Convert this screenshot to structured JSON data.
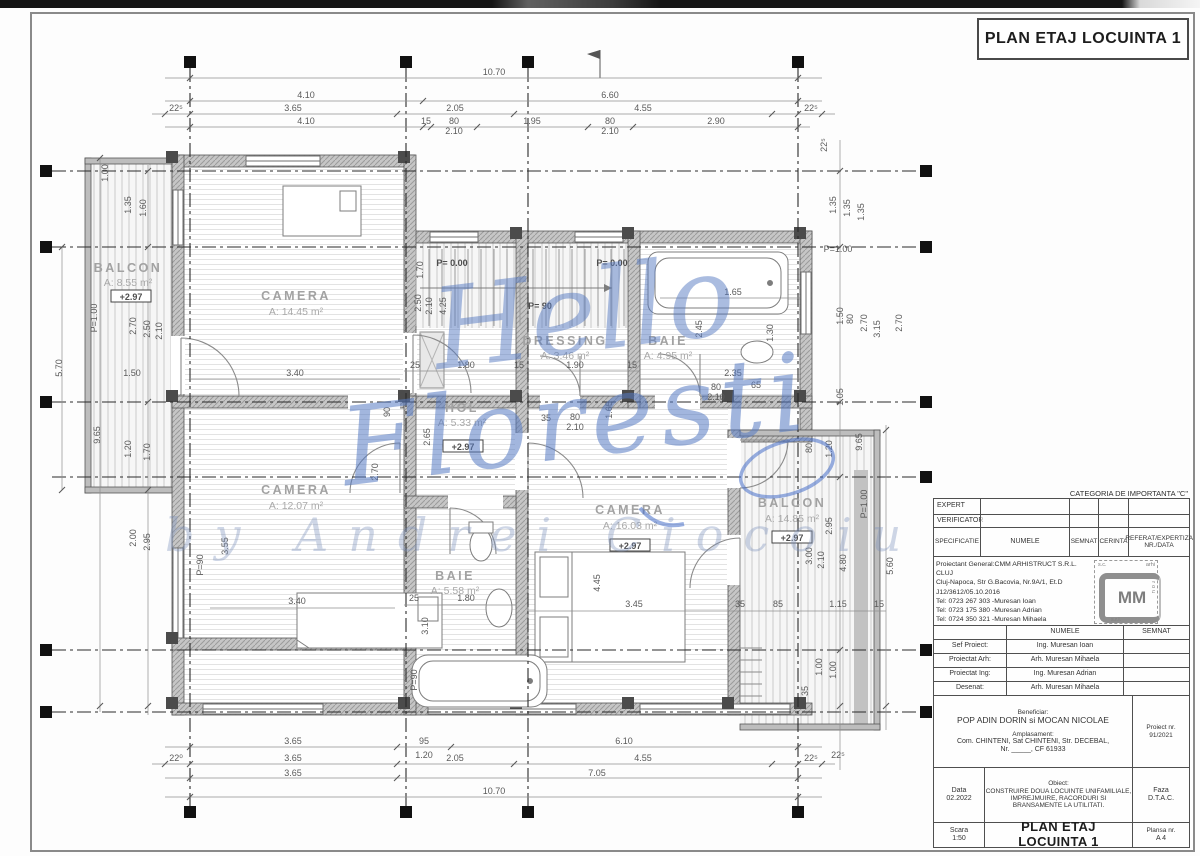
{
  "title": "PLAN ETAJ LOCUINTA 1",
  "watermark": {
    "line1": "Hello",
    "line2": "Floresti",
    "line3": "by Andrei Ciocoiu"
  },
  "plan": {
    "rooms": [
      {
        "name": "BALCON",
        "area": "A: 8.55 m²",
        "level": "+2.97"
      },
      {
        "name": "CAMERA",
        "area": "A: 14.45 m²",
        "level": ""
      },
      {
        "name": "DRESSING",
        "area": "A: 3.46 m²",
        "level": ""
      },
      {
        "name": "BAIE",
        "area": "A: 4.95 m²",
        "level": ""
      },
      {
        "name": "HOL",
        "area": "A: 5.33 m²",
        "level": "+2.97"
      },
      {
        "name": "CAMERA",
        "area": "A: 12.07 m²",
        "level": ""
      },
      {
        "name": "BAIE",
        "area": "A: 5.58 m²",
        "level": ""
      },
      {
        "name": "CAMERA",
        "area": "A: 16.03 m²",
        "level": "+2.97"
      },
      {
        "name": "BALCON",
        "area": "A: 14.85 m²",
        "level": "+2.97"
      }
    ],
    "dims_top": [
      "10.70",
      "4.10",
      "6.60",
      "22⁵",
      "3.65",
      "2.05",
      "4.55",
      "22⁵",
      "4.10",
      "15",
      "80",
      "2.10",
      "1.95",
      "80",
      "2.10",
      "2.90"
    ],
    "dims_bottom": [
      "3.65",
      "95",
      "1.20",
      "6.10",
      "22⁰",
      "3.65",
      "2.05",
      "4.55",
      "22⁵",
      "3.65",
      "7.05",
      "10.70"
    ],
    "dims_left": [
      "1.00",
      "1.35",
      "1.60",
      "5.70",
      "P=1.00",
      "2.70",
      "2.50",
      "2.10",
      "1.50",
      "9.65",
      "1.20",
      "1.70",
      "2.00",
      "2.95"
    ],
    "dims_right": [
      "22⁵",
      "1.35",
      "1.35",
      "1.35",
      "P=1.00",
      "1.50",
      "80",
      "2.70",
      "3.15",
      "2.70",
      "1.05",
      "80",
      "1.20",
      "9.65",
      "2.95",
      "2.10",
      "3.00",
      "4.80",
      "5.60",
      "P=1.00",
      "1.00",
      "1.00",
      "35",
      "22⁵"
    ],
    "dims_inner": [
      "3.40",
      "4.25",
      "2.50",
      "2.10",
      "1.70",
      "P= 0.00",
      "P= 0.00",
      "P= 90",
      "25",
      "1.80",
      "15",
      "1.90",
      "15",
      "1.65",
      "2.45",
      "1.30",
      "2.35",
      "80",
      "2.10",
      "65",
      "80",
      "2.10",
      "1.65",
      "35",
      "2.65",
      "3.55",
      "P=90",
      "3.40",
      "2.70",
      "25",
      "1.80",
      "3.10",
      "4.45",
      "3.45",
      "35",
      "85",
      "1.15",
      "15",
      "P=90",
      "90"
    ],
    "level_marks": [
      "+2.97",
      "+2.97",
      "+2.97",
      "+2.97"
    ]
  },
  "titleblock": {
    "category": "CATEGORIA DE IMPORTANTA \"C\"",
    "approval": {
      "row1": "EXPERT",
      "row2": "VERIFICATOR",
      "row3": "SPECIFICATIE",
      "h_numele": "NUMELE",
      "h_semnat": "SEMNAT",
      "h_cerinta": "CERINTA",
      "h_referat": "REFERAT/EXPERTIZA NR./DATA"
    },
    "designer_lines": [
      "Proiectant General:CMM ARHISTRUCT S.R.L. CLUJ",
      "Cluj-Napoca, Str G.Bacovia, Nr.9A/1, Et.D",
      "J12/3612/05.10.2016",
      "Tel: 0723 267 303 -Muresan Ioan",
      "Tel: 0723 175 380 -Muresan Adrian",
      "Tel: 0724 350 321 -Muresan Mihaela"
    ],
    "logo": {
      "mm": "MM",
      "sc": "s.c.",
      "arhi": "arhi",
      "birou": "birou",
      "srl": "s.r.l."
    },
    "team": {
      "h_numele": "NUMELE",
      "h_semnat": "SEMNAT",
      "rows": [
        {
          "label": "Sef Proiect:",
          "name": "Ing. Muresan Ioan"
        },
        {
          "label": "Proiectat Arh:",
          "name": "Arh. Muresan Mihaela"
        },
        {
          "label": "Proiectat Ing:",
          "name": "Ing. Muresan Adrian"
        },
        {
          "label": "Desenat:",
          "name": "Arh. Muresan Mihaela"
        }
      ]
    },
    "beneficiar_label": "Beneficiar:",
    "beneficiar": "POP ADIN DORIN si MOCAN NICOLAE",
    "amplasament_label": "Amplasament:",
    "amplasament1": "Com. CHINTENI, Sat CHINTENI, Str. DECEBAL,",
    "amplasament2": "Nr. _____, CF 61933",
    "proiect_label": "Proiect nr.",
    "proiect_nr": "91/2021",
    "data_label": "Data",
    "data_value": "02.2022",
    "obiect_label": "Obiect:",
    "obiect1": "CONSTRUIRE DOUA LOCUINTE UNIFAMILIALE,",
    "obiect2": "IMPREJMUIRE, RACORDURI SI",
    "obiect3": "BRANSAMENTE LA UTILITATI.",
    "faza_label": "Faza",
    "faza": "D.T.A.C.",
    "scara_label": "Scara",
    "scara": "1:50",
    "plan_title": "PLAN ETAJ LOCUINTA 1",
    "plansa_label": "Plansa nr.",
    "plansa": "A 4"
  }
}
